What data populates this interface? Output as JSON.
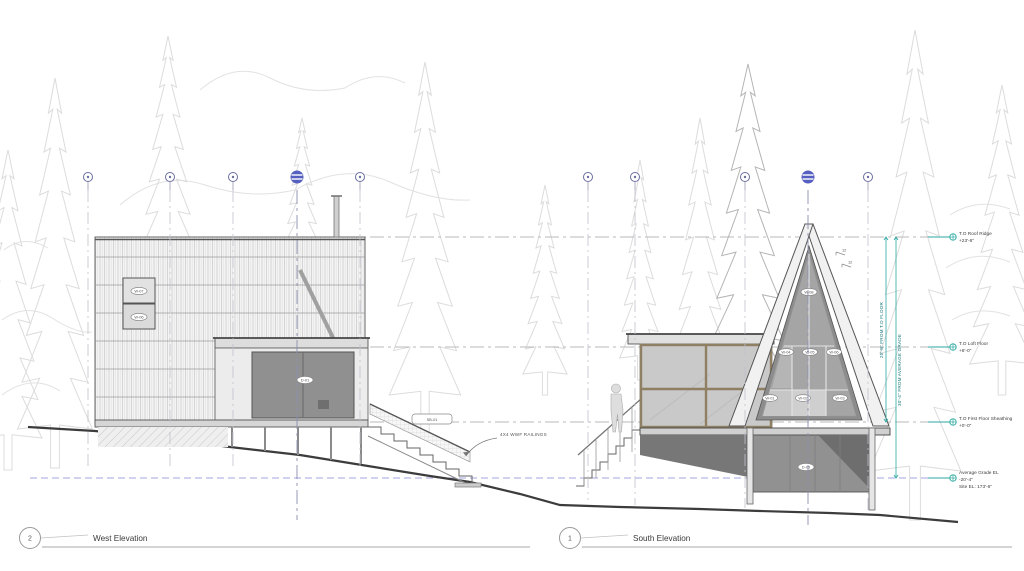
{
  "views": [
    {
      "number": "2",
      "title": "West Elevation"
    },
    {
      "number": "1",
      "title": "South Elevation"
    }
  ],
  "levels": [
    {
      "name": "T.O Roof Ridge",
      "elev": "+23'-6\""
    },
    {
      "name": "T.O Loft Floor",
      "elev": "+8'-0\""
    },
    {
      "name": "T.O First Floor Sheathing",
      "elev": "+0'-0\""
    },
    {
      "name": "Average Grade EL",
      "elev": "-20'-4\"",
      "site": "Site EL: 173'-6\""
    }
  ],
  "dims": {
    "ridge_to_floor": "25'-8\" FROM T.O FLOOR",
    "ridge_to_grade": "30'-4\" FROM AVERAGE GRADE"
  },
  "notes": {
    "railing": "4X4 WWF RAILINGS",
    "pitch_a": "12",
    "pitch_b": "12"
  },
  "tags": {
    "west_window_upper": "W-07",
    "west_window_lower": "W-06",
    "west_door": "D-01",
    "stair": "SB-01",
    "gable_top": "W-08",
    "gable_mid": [
      "W-04",
      "W-05",
      "W-06"
    ],
    "gable_bottom": [
      "W-01",
      "W-02",
      "W-03"
    ],
    "garage_door": "D-05"
  },
  "colors": {
    "accent_teal": "#2aa7a0",
    "accent_blue": "#5560c0",
    "grade_dash": "#9a9ade",
    "line_gray": "#9a9a9a"
  }
}
